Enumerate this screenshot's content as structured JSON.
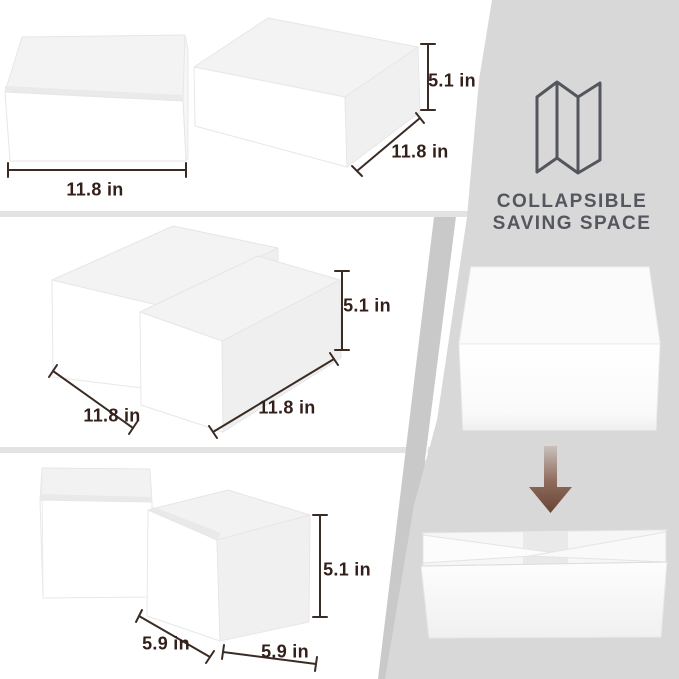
{
  "headline": {
    "line1": "COLLAPSIBLE",
    "line2": "SAVING SPACE"
  },
  "sections": {
    "top": {
      "width": "11.8 in",
      "depth": "11.8 in",
      "height": "5.1 in"
    },
    "middle": {
      "width": "11.8 in",
      "depth": "11.8 in",
      "height": "5.1 in"
    },
    "bottom": {
      "width": "5.9 in",
      "depth": "5.9 in",
      "height": "5.1 in"
    }
  },
  "icons": {
    "panel_icon": "trifold-divider-icon",
    "arrow_icon": "collapse-down-arrow-icon"
  },
  "colors": {
    "panel_gray": "#d8d8d8",
    "panel_back_gray": "#c9c9c9",
    "divider_gray": "#e3e3e3",
    "dimension_text": "#33201a",
    "heading_text": "#54575d",
    "arrow_brown": "#6a4435"
  }
}
